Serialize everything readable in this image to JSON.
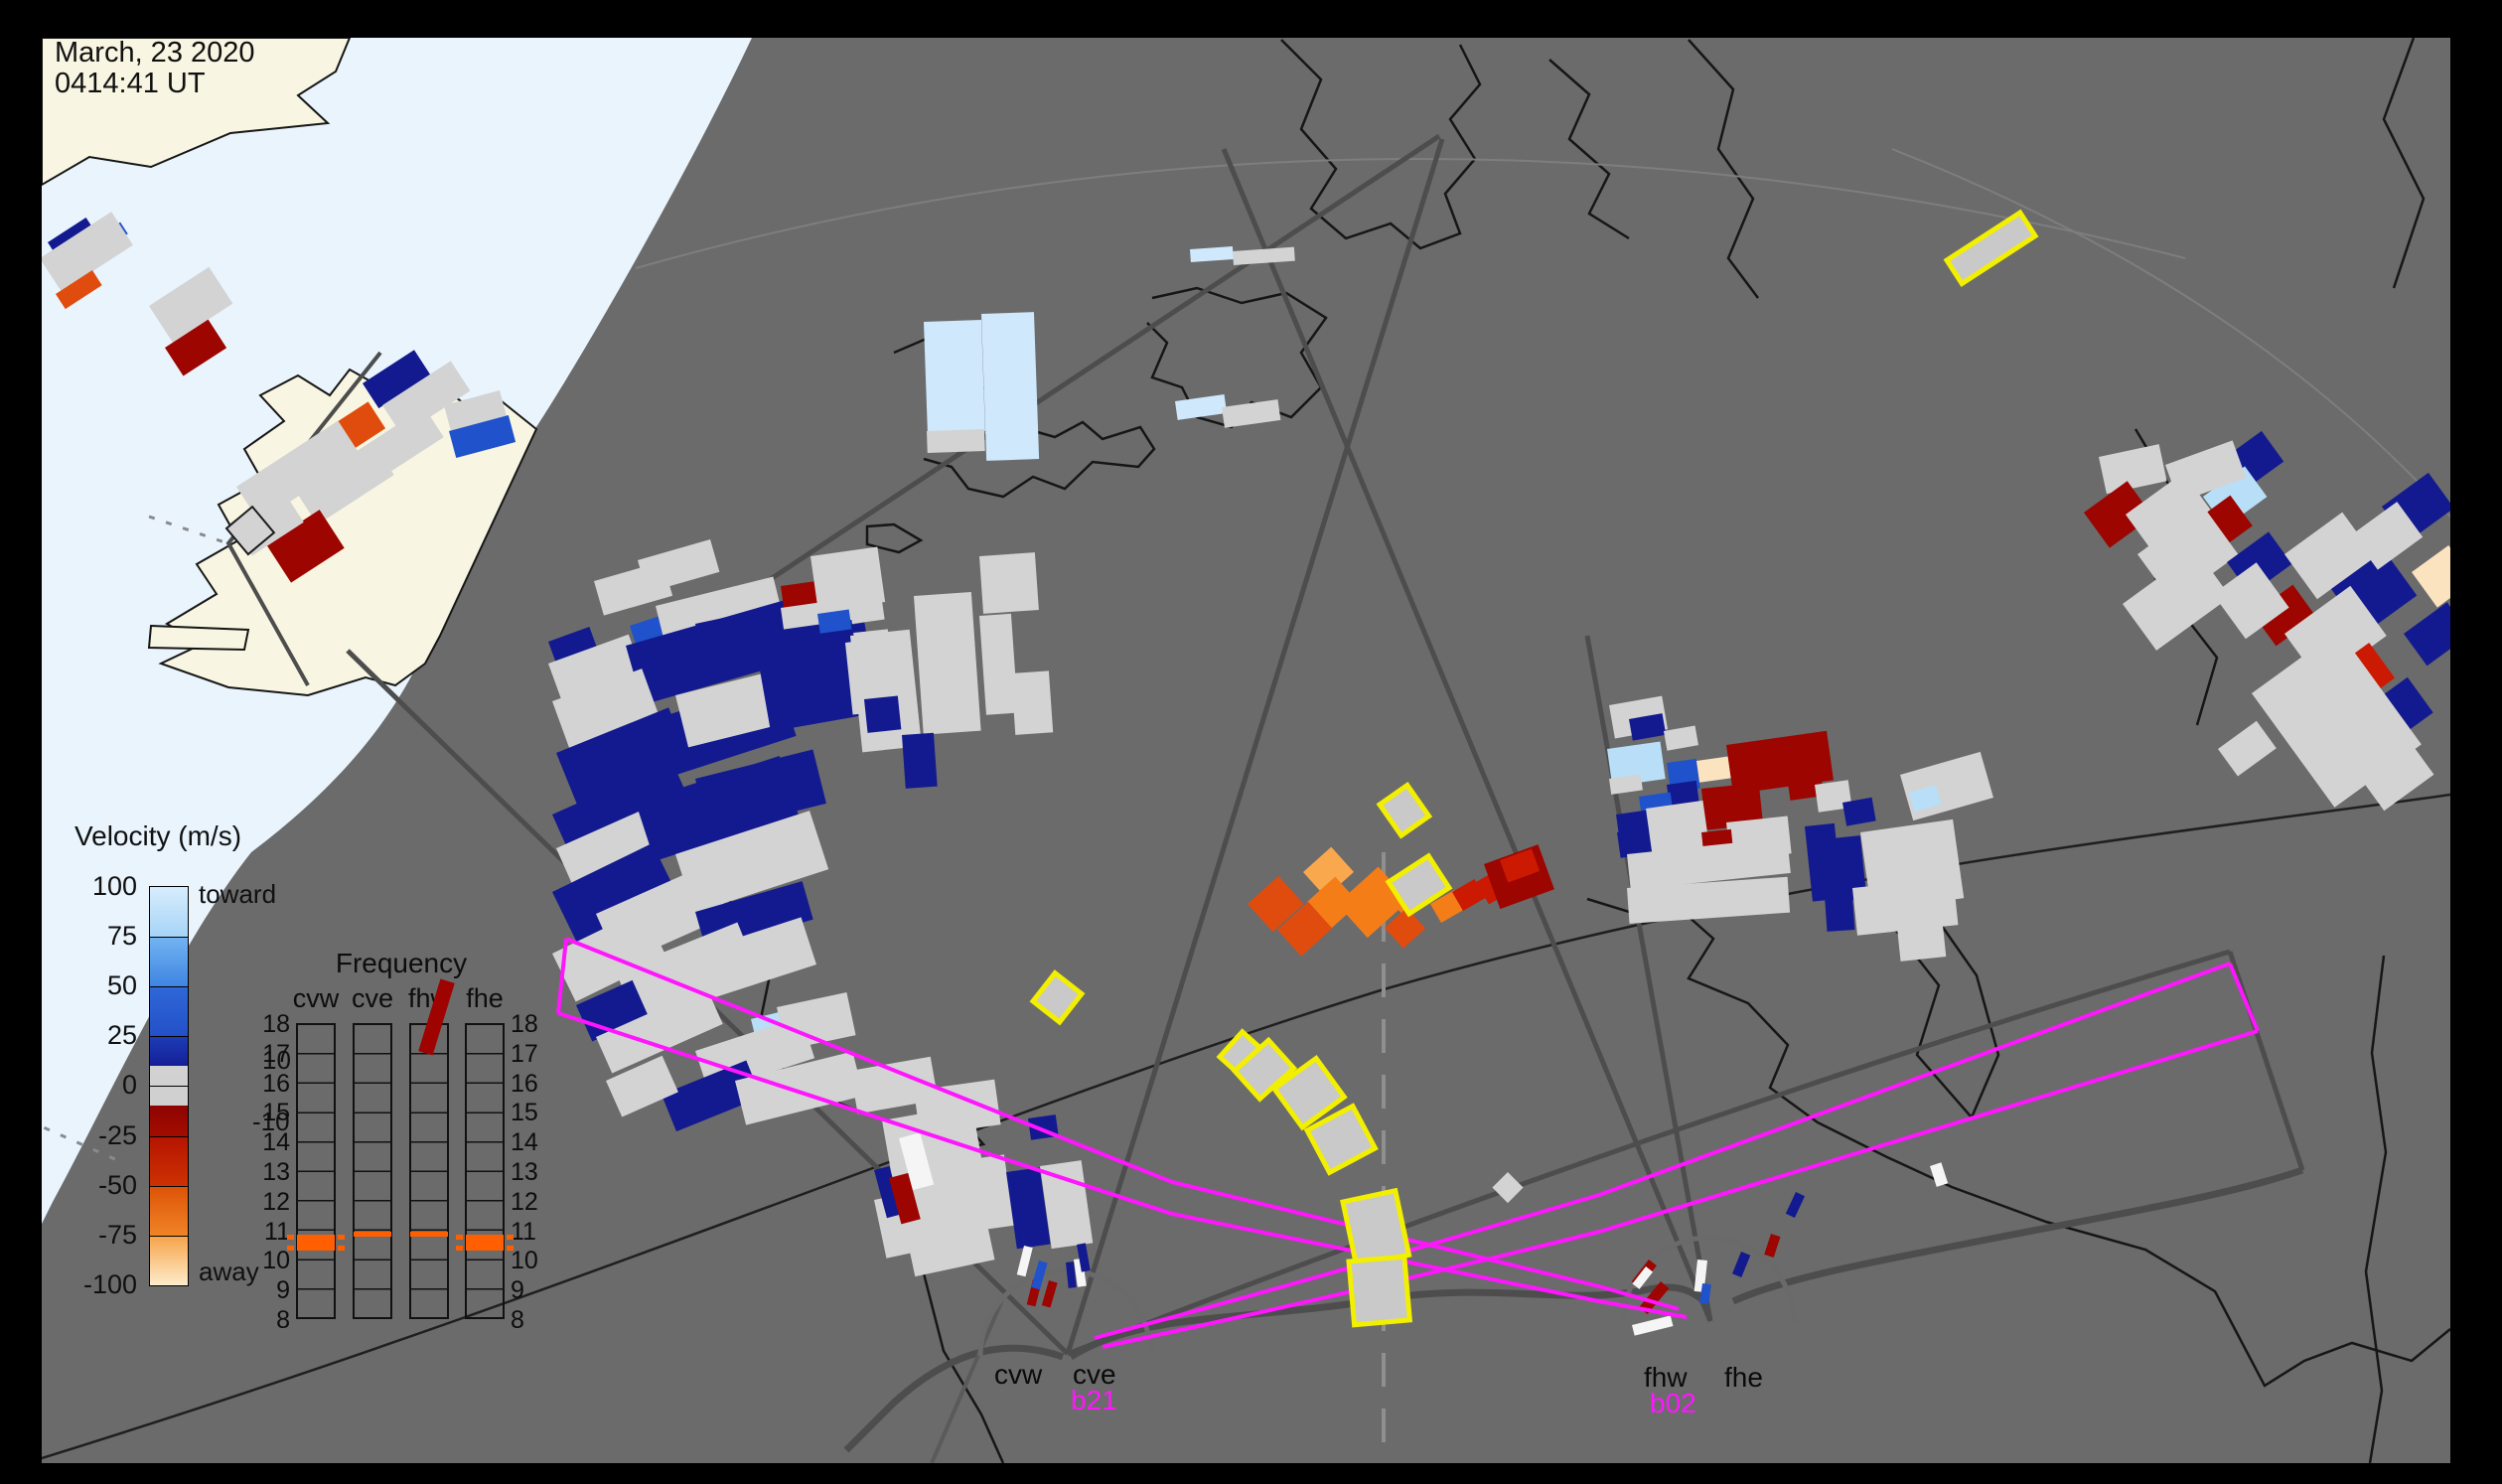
{
  "timestamp": {
    "line1": "March, 23 2020",
    "line2": "0414:41 UT"
  },
  "velocity_legend": {
    "title": "Velocity (m/s)",
    "ticks": [
      "100",
      "75",
      "50",
      "25",
      "0",
      "-25",
      "-50",
      "-75",
      "-100"
    ],
    "tick_y": [
      0,
      50,
      100,
      150,
      200,
      251,
      301,
      351,
      401
    ],
    "toward_label": "toward",
    "away_label": "away",
    "inner_pos_label": "10",
    "inner_neg_label": "-10",
    "segments": [
      [
        "#d7edfc",
        "#a6d4f8",
        50
      ],
      [
        "#73b4f1",
        "#3f85e2",
        50
      ],
      [
        "#2f68d8",
        "#2350c8",
        50
      ],
      [
        "#1d3db6",
        "#141f97",
        30
      ],
      [
        "#d2d2d2",
        "#cfcfcf",
        40
      ],
      [
        "#8e0300",
        "#a30d00",
        31
      ],
      [
        "#b41400",
        "#cd3203",
        50
      ],
      [
        "#dd5207",
        "#f08426",
        50
      ],
      [
        "#f6a348",
        "#fdeccb",
        50
      ]
    ]
  },
  "frequency_panel": {
    "title": "Frequency",
    "columns": [
      "cvw",
      "cve",
      "fhw",
      "fhe"
    ],
    "col_x": [
      298,
      355,
      412,
      468
    ],
    "scale": [
      "18",
      "17",
      "16",
      "15",
      "14",
      "13",
      "12",
      "11",
      "10",
      "9",
      "8"
    ],
    "marks": [
      {
        "col": 0,
        "kind": "block"
      },
      {
        "col": 1,
        "kind": "line"
      },
      {
        "col": 2,
        "kind": "line"
      },
      {
        "col": 3,
        "kind": "block"
      }
    ],
    "mark_color": "#ff5f00"
  },
  "sites": [
    {
      "name_left": "cvw",
      "name_right": "cve",
      "beam": "b21"
    },
    {
      "name_left": "fhw",
      "name_right": "fhe",
      "beam": "b02"
    }
  ],
  "colors": {
    "frame": "#000000",
    "map_bg": "#6b6b6b",
    "ocean_lit": "#e9f4fd",
    "land_lit": "#f8f6e2",
    "coast": "#161616",
    "fov": "#4d4d4d",
    "magenta": "#ff16ff",
    "yellow": "#f2ef00",
    "red_stripe": "#9e0300",
    "cells": {
      "g": "#d3d3d3",
      "w": "#f5f5f5",
      "n": "#131a8f",
      "b": "#1f52cb",
      "lb": "#b9def7",
      "vb": "#cfe8fc",
      "dr": "#9c0500",
      "r": "#cb1902",
      "or": "#e04c0e",
      "o": "#f57d18",
      "lo": "#faa84e",
      "cr": "#fbe3c0"
    }
  },
  "map": {
    "cells": [
      [
        598,
        585,
        72,
        36,
        -16,
        "g"
      ],
      [
        642,
        564,
        76,
        34,
        -16,
        "g"
      ],
      [
        552,
        646,
        44,
        26,
        -20,
        "n"
      ],
      [
        552,
        668,
        86,
        40,
        -20,
        "g"
      ],
      [
        634,
        630,
        42,
        28,
        -18,
        "b"
      ],
      [
        660,
        610,
        122,
        34,
        -14,
        "g"
      ],
      [
        630,
        650,
        172,
        62,
        -16,
        "n"
      ],
      [
        700,
        628,
        112,
        50,
        -12,
        "n"
      ],
      [
        556,
        706,
        96,
        58,
        -20,
        "g"
      ],
      [
        560,
        758,
        122,
        56,
        -22,
        "n"
      ],
      [
        610,
        740,
        182,
        60,
        -18,
        "n"
      ],
      [
        680,
        700,
        140,
        54,
        -14,
        "g"
      ],
      [
        760,
        646,
        112,
        92,
        -10,
        "n"
      ],
      [
        850,
        638,
        44,
        82,
        -6,
        "g"
      ],
      [
        556,
        820,
        132,
        40,
        -24,
        "n"
      ],
      [
        560,
        854,
        122,
        42,
        -24,
        "g"
      ],
      [
        640,
        808,
        152,
        62,
        -18,
        "n"
      ],
      [
        700,
        784,
        122,
        56,
        -14,
        "n"
      ],
      [
        556,
        898,
        112,
        60,
        -26,
        "n"
      ],
      [
        600,
        920,
        122,
        56,
        -24,
        "g"
      ],
      [
        680,
        860,
        142,
        62,
        -18,
        "g"
      ],
      [
        700,
        918,
        112,
        40,
        -16,
        "n"
      ],
      [
        556,
        960,
        102,
        54,
        -26,
        "g"
      ],
      [
        620,
        978,
        132,
        56,
        -22,
        "g"
      ],
      [
        700,
        958,
        112,
        50,
        -18,
        "g"
      ],
      [
        580,
        1012,
        62,
        40,
        -24,
        "n"
      ],
      [
        756,
        1026,
        32,
        28,
        -14,
        "lb"
      ],
      [
        782,
        1014,
        72,
        44,
        -12,
        "g"
      ],
      [
        786,
        590,
        38,
        22,
        -8,
        "dr"
      ],
      [
        786,
        612,
        102,
        26,
        -8,
        "g"
      ],
      [
        786,
        634,
        72,
        22,
        -8,
        "n"
      ],
      [
        823,
        618,
        32,
        20,
        -8,
        "b"
      ],
      [
        816,
        560,
        68,
        56,
        -8,
        "g"
      ],
      [
        856,
        640,
        60,
        118,
        -6,
        "g"
      ],
      [
        920,
        600,
        58,
        140,
        -4,
        "g"
      ],
      [
        908,
        740,
        32,
        54,
        -4,
        "n"
      ],
      [
        870,
        704,
        34,
        34,
        -6,
        "n"
      ],
      [
        986,
        560,
        56,
        58,
        -4,
        "g"
      ],
      [
        986,
        620,
        32,
        100,
        -4,
        "g"
      ],
      [
        1018,
        678,
        38,
        62,
        -4,
        "g"
      ],
      [
        600,
        1044,
        122,
        40,
        -24,
        "g"
      ],
      [
        700,
        1058,
        112,
        44,
        -18,
        "g"
      ],
      [
        666,
        1102,
        92,
        40,
        -22,
        "n"
      ],
      [
        610,
        1088,
        62,
        40,
        -24,
        "g"
      ],
      [
        740,
        1088,
        122,
        46,
        -14,
        "g"
      ],
      [
        856,
        1078,
        82,
        44,
        -10,
        "g"
      ],
      [
        920,
        1098,
        82,
        46,
        -8,
        "g"
      ],
      [
        888,
        1128,
        92,
        60,
        -10,
        "g"
      ],
      [
        900,
        1178,
        112,
        72,
        -8,
        "g"
      ],
      [
        1035,
        1126,
        28,
        22,
        -8,
        "n"
      ],
      [
        1013,
        1180,
        34,
        78,
        -8,
        "n"
      ],
      [
        1047,
        1174,
        42,
        84,
        -8,
        "g"
      ],
      [
        913,
        1246,
        82,
        40,
        -12,
        "g"
      ],
      [
        880,
        1208,
        34,
        60,
        -12,
        "g"
      ],
      [
        880,
        1178,
        16,
        50,
        -15,
        "n"
      ],
      [
        895,
        1186,
        20,
        48,
        -15,
        "dr"
      ],
      [
        905,
        1146,
        22,
        54,
        -15,
        "w"
      ],
      [
        365,
        386,
        62,
        30,
        -33,
        "n"
      ],
      [
        385,
        408,
        82,
        36,
        -33,
        "g"
      ],
      [
        322,
        436,
        58,
        32,
        -33,
        "or"
      ],
      [
        350,
        460,
        92,
        36,
        -33,
        "g"
      ],
      [
        238,
        490,
        122,
        42,
        -33,
        "g"
      ],
      [
        300,
        498,
        92,
        36,
        -33,
        "g"
      ],
      [
        268,
        548,
        64,
        46,
        -33,
        "dr"
      ],
      [
        232,
        526,
        62,
        40,
        -33,
        "g"
      ],
      [
        447,
        408,
        58,
        30,
        -15,
        "g"
      ],
      [
        452,
        434,
        62,
        28,
        -15,
        "b"
      ],
      [
        48,
        244,
        46,
        16,
        -33,
        "n"
      ],
      [
        96,
        240,
        30,
        14,
        -33,
        "b"
      ],
      [
        40,
        260,
        86,
        40,
        -33,
        "g"
      ],
      [
        56,
        296,
        44,
        18,
        -33,
        "or"
      ],
      [
        150,
        308,
        72,
        44,
        -33,
        "g"
      ],
      [
        166,
        350,
        52,
        34,
        -33,
        "dr"
      ],
      [
        930,
        324,
        58,
        112,
        -2,
        "vb"
      ],
      [
        933,
        434,
        58,
        22,
        -2,
        "g"
      ],
      [
        988,
        316,
        53,
        148,
        -2,
        "vb"
      ],
      [
        1183,
        404,
        50,
        19,
        -8,
        "vb"
      ],
      [
        1230,
        410,
        57,
        21,
        -8,
        "g"
      ],
      [
        1198,
        251,
        43,
        13,
        -4,
        "vb"
      ],
      [
        1241,
        253,
        62,
        14,
        -4,
        "g"
      ],
      [
        1312,
        878,
        38,
        34,
        -42,
        "lo"
      ],
      [
        1316,
        908,
        38,
        36,
        -42,
        "o"
      ],
      [
        1256,
        910,
        42,
        38,
        -42,
        "or"
      ],
      [
        1286,
        936,
        42,
        36,
        -42,
        "or"
      ],
      [
        1346,
        910,
        56,
        46,
        -42,
        "o"
      ],
      [
        1406,
        914,
        24,
        16,
        -42,
        "o"
      ],
      [
        1394,
        934,
        30,
        28,
        -42,
        "or"
      ],
      [
        1440,
        910,
        28,
        22,
        -30,
        "o"
      ],
      [
        1462,
        898,
        26,
        22,
        -30,
        "r"
      ],
      [
        1486,
        888,
        26,
        26,
        -30,
        "r"
      ],
      [
        1494,
        870,
        58,
        48,
        -20,
        "dr"
      ],
      [
        1510,
        866,
        34,
        24,
        -20,
        "r"
      ],
      [
        1620,
        710,
        54,
        34,
        -10,
        "g"
      ],
      [
        1640,
        724,
        34,
        22,
        -10,
        "n"
      ],
      [
        1675,
        736,
        32,
        20,
        -10,
        "g"
      ],
      [
        1618,
        754,
        54,
        38,
        -8,
        "lb"
      ],
      [
        1620,
        784,
        32,
        16,
        -8,
        "g"
      ],
      [
        1678,
        768,
        30,
        30,
        -8,
        "b"
      ],
      [
        1678,
        790,
        30,
        28,
        -8,
        "n"
      ],
      [
        1708,
        766,
        32,
        22,
        -8,
        "cr"
      ],
      [
        1738,
        750,
        102,
        50,
        -8,
        "dr"
      ],
      [
        1800,
        788,
        34,
        18,
        -8,
        "dr"
      ],
      [
        1827,
        790,
        34,
        28,
        -8,
        "g"
      ],
      [
        1913,
        780,
        84,
        48,
        -16,
        "g"
      ],
      [
        1922,
        798,
        28,
        20,
        -16,
        "lb"
      ],
      [
        1855,
        808,
        30,
        24,
        -10,
        "n"
      ],
      [
        1650,
        802,
        32,
        24,
        -8,
        "b"
      ],
      [
        1627,
        820,
        32,
        24,
        -8,
        "n"
      ],
      [
        1628,
        838,
        32,
        26,
        -8,
        "n"
      ],
      [
        1713,
        794,
        58,
        42,
        -6,
        "dr"
      ],
      [
        1657,
        814,
        58,
        48,
        -8,
        "g"
      ],
      [
        1738,
        828,
        62,
        38,
        -6,
        "g"
      ],
      [
        1713,
        838,
        30,
        38,
        -6,
        "dr"
      ],
      [
        1638,
        860,
        162,
        36,
        -6,
        "g"
      ],
      [
        1638,
        894,
        162,
        36,
        -4,
        "g"
      ],
      [
        1817,
        832,
        30,
        76,
        -6,
        "n"
      ],
      [
        1845,
        844,
        28,
        64,
        -6,
        "n"
      ],
      [
        1873,
        838,
        94,
        80,
        -8,
        "g"
      ],
      [
        1837,
        902,
        28,
        36,
        -4,
        "n"
      ],
      [
        1865,
        894,
        102,
        48,
        -6,
        "g"
      ],
      [
        1910,
        934,
        46,
        34,
        -6,
        "g"
      ],
      [
        2113,
        460,
        62,
        38,
        -12,
        "g"
      ],
      [
        2230,
        468,
        58,
        38,
        -36,
        "n"
      ],
      [
        2218,
        500,
        52,
        38,
        -36,
        "lb"
      ],
      [
        2098,
        516,
        54,
        44,
        -36,
        "dr"
      ],
      [
        2140,
        518,
        72,
        52,
        -36,
        "g"
      ],
      [
        2205,
        528,
        50,
        38,
        -36,
        "dr"
      ],
      [
        2152,
        558,
        82,
        60,
        -36,
        "g"
      ],
      [
        2242,
        566,
        52,
        40,
        -36,
        "n"
      ],
      [
        2137,
        608,
        92,
        58,
        -36,
        "g"
      ],
      [
        2268,
        618,
        50,
        40,
        -36,
        "dr"
      ],
      [
        2228,
        598,
        54,
        56,
        -36,
        "g"
      ],
      [
        2300,
        558,
        72,
        56,
        -36,
        "g"
      ],
      [
        2347,
        593,
        66,
        56,
        -36,
        "n"
      ],
      [
        2398,
        510,
        58,
        44,
        -36,
        "n"
      ],
      [
        2368,
        538,
        56,
        44,
        -36,
        "g"
      ],
      [
        2428,
        576,
        46,
        44,
        -36,
        "cr"
      ],
      [
        2300,
        638,
        82,
        62,
        -36,
        "g"
      ],
      [
        2348,
        674,
        46,
        44,
        -36,
        "r"
      ],
      [
        2385,
        710,
        48,
        44,
        -36,
        "n"
      ],
      [
        2267,
        698,
        108,
        142,
        -36,
        "g"
      ],
      [
        2233,
        754,
        48,
        34,
        -36,
        "g"
      ],
      [
        2420,
        638,
        54,
        40,
        -36,
        "n"
      ],
      [
        2358,
        758,
        62,
        72,
        -36,
        "g"
      ],
      [
        2180,
        468,
        72,
        40,
        -20,
        "g"
      ],
      [
        1518,
        1180,
        22,
        22,
        45,
        "g"
      ],
      [
        1943,
        1174,
        12,
        22,
        -18,
        "w"
      ],
      [
        1783,
        1242,
        10,
        22,
        18,
        "dr"
      ],
      [
        1808,
        1200,
        10,
        24,
        25,
        "n"
      ]
    ],
    "outlined_cell": [
      228,
      532,
      34,
      34,
      -40,
      "g"
    ],
    "yellow_cells": [
      [
        1960,
        262,
        88,
        28,
        -33
      ],
      [
        1389,
        810,
        34,
        38,
        -35
      ],
      [
        1398,
        888,
        48,
        38,
        -33
      ],
      [
        1040,
        1008,
        36,
        34,
        -52
      ],
      [
        1228,
        1064,
        34,
        36,
        -48
      ],
      [
        1243,
        1078,
        46,
        38,
        -42
      ],
      [
        1283,
        1096,
        52,
        48,
        -36
      ],
      [
        1316,
        1138,
        52,
        48,
        -28
      ],
      [
        1352,
        1210,
        54,
        66,
        -12
      ],
      [
        1358,
        1270,
        56,
        64,
        -5
      ]
    ],
    "vector_sticks": [
      [
        1031,
        1254,
        9,
        30,
        14,
        "w"
      ],
      [
        1040,
        1288,
        9,
        26,
        14,
        "dr"
      ],
      [
        1046,
        1269,
        9,
        28,
        16,
        "b"
      ],
      [
        1056,
        1289,
        9,
        26,
        16,
        "dr"
      ],
      [
        1073,
        1271,
        8,
        26,
        -6,
        "n"
      ],
      [
        1081,
        1268,
        9,
        28,
        -8,
        "w"
      ],
      [
        1084,
        1253,
        9,
        28,
        -10,
        "n"
      ],
      [
        1660,
        1268,
        10,
        28,
        38,
        "dr"
      ],
      [
        1657,
        1275,
        9,
        22,
        38,
        "w"
      ],
      [
        1672,
        1290,
        11,
        34,
        40,
        "dr"
      ],
      [
        1709,
        1268,
        10,
        32,
        6,
        "w"
      ],
      [
        1714,
        1292,
        9,
        20,
        8,
        "b"
      ],
      [
        1753,
        1260,
        10,
        24,
        22,
        "n"
      ],
      [
        1643,
        1334,
        40,
        11,
        -14,
        "w"
      ]
    ]
  }
}
